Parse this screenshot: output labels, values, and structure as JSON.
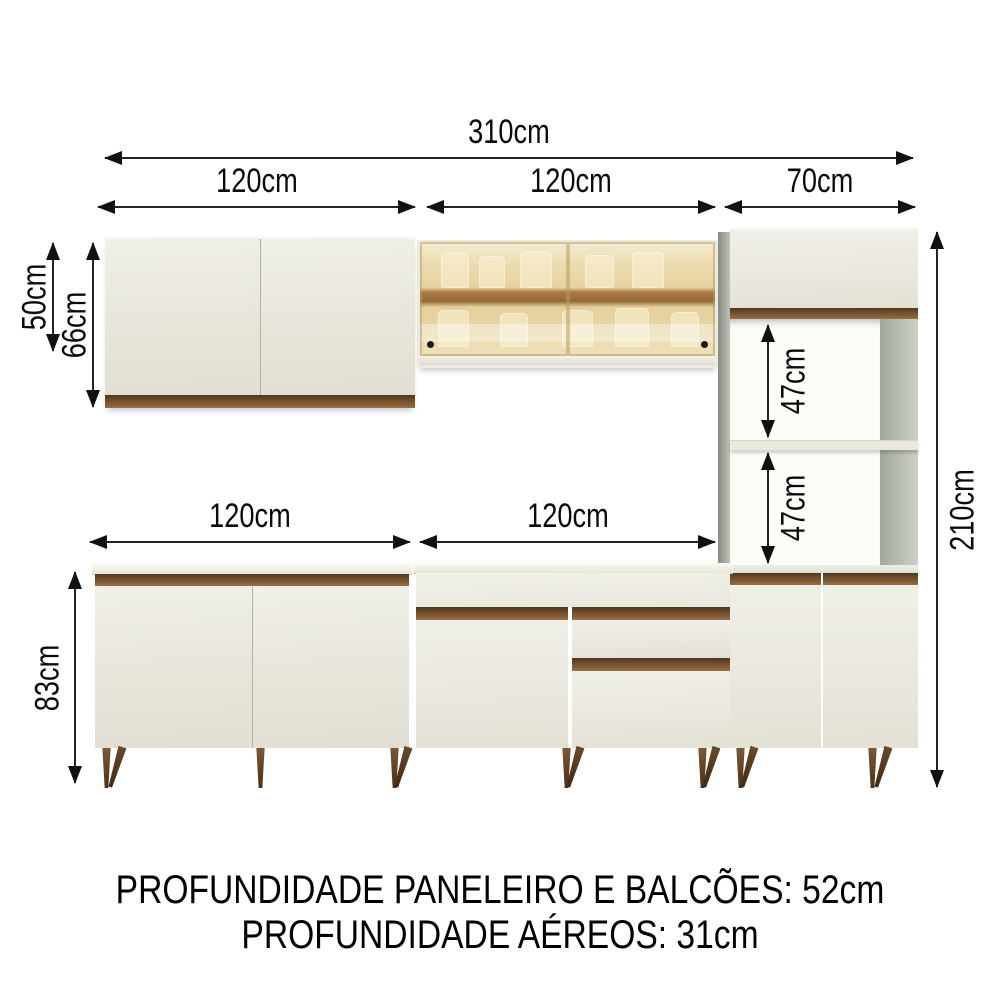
{
  "diagram_title": "kitchen-cabinet-dimension-diagram",
  "dimensions": {
    "total_width": "310cm",
    "aerial_left_width": "120cm",
    "aerial_middle_width": "120cm",
    "right_width": "70cm",
    "glass_cabinet_height": "50cm",
    "aerial_cabinet_height": "66cm",
    "counter_left_width": "120cm",
    "counter_middle_width": "120cm",
    "niche_upper_height": "47cm",
    "niche_lower_height": "47cm",
    "total_height": "210cm",
    "counter_height": "83cm"
  },
  "footer": {
    "line1": "PROFUNDIDADE PANELEIRO E BALCÕES: 52cm",
    "line2": "PROFUNDIDADE AÉREOS: 31cm"
  },
  "colors": {
    "cabinet_white": "#ebe9e0",
    "wood_brown": "#7b5634",
    "glass_amber": "#e6d2a0",
    "leg_brown": "#6a482a",
    "panel_gray": "#b4b9ae",
    "dimension_line": "#232323"
  }
}
